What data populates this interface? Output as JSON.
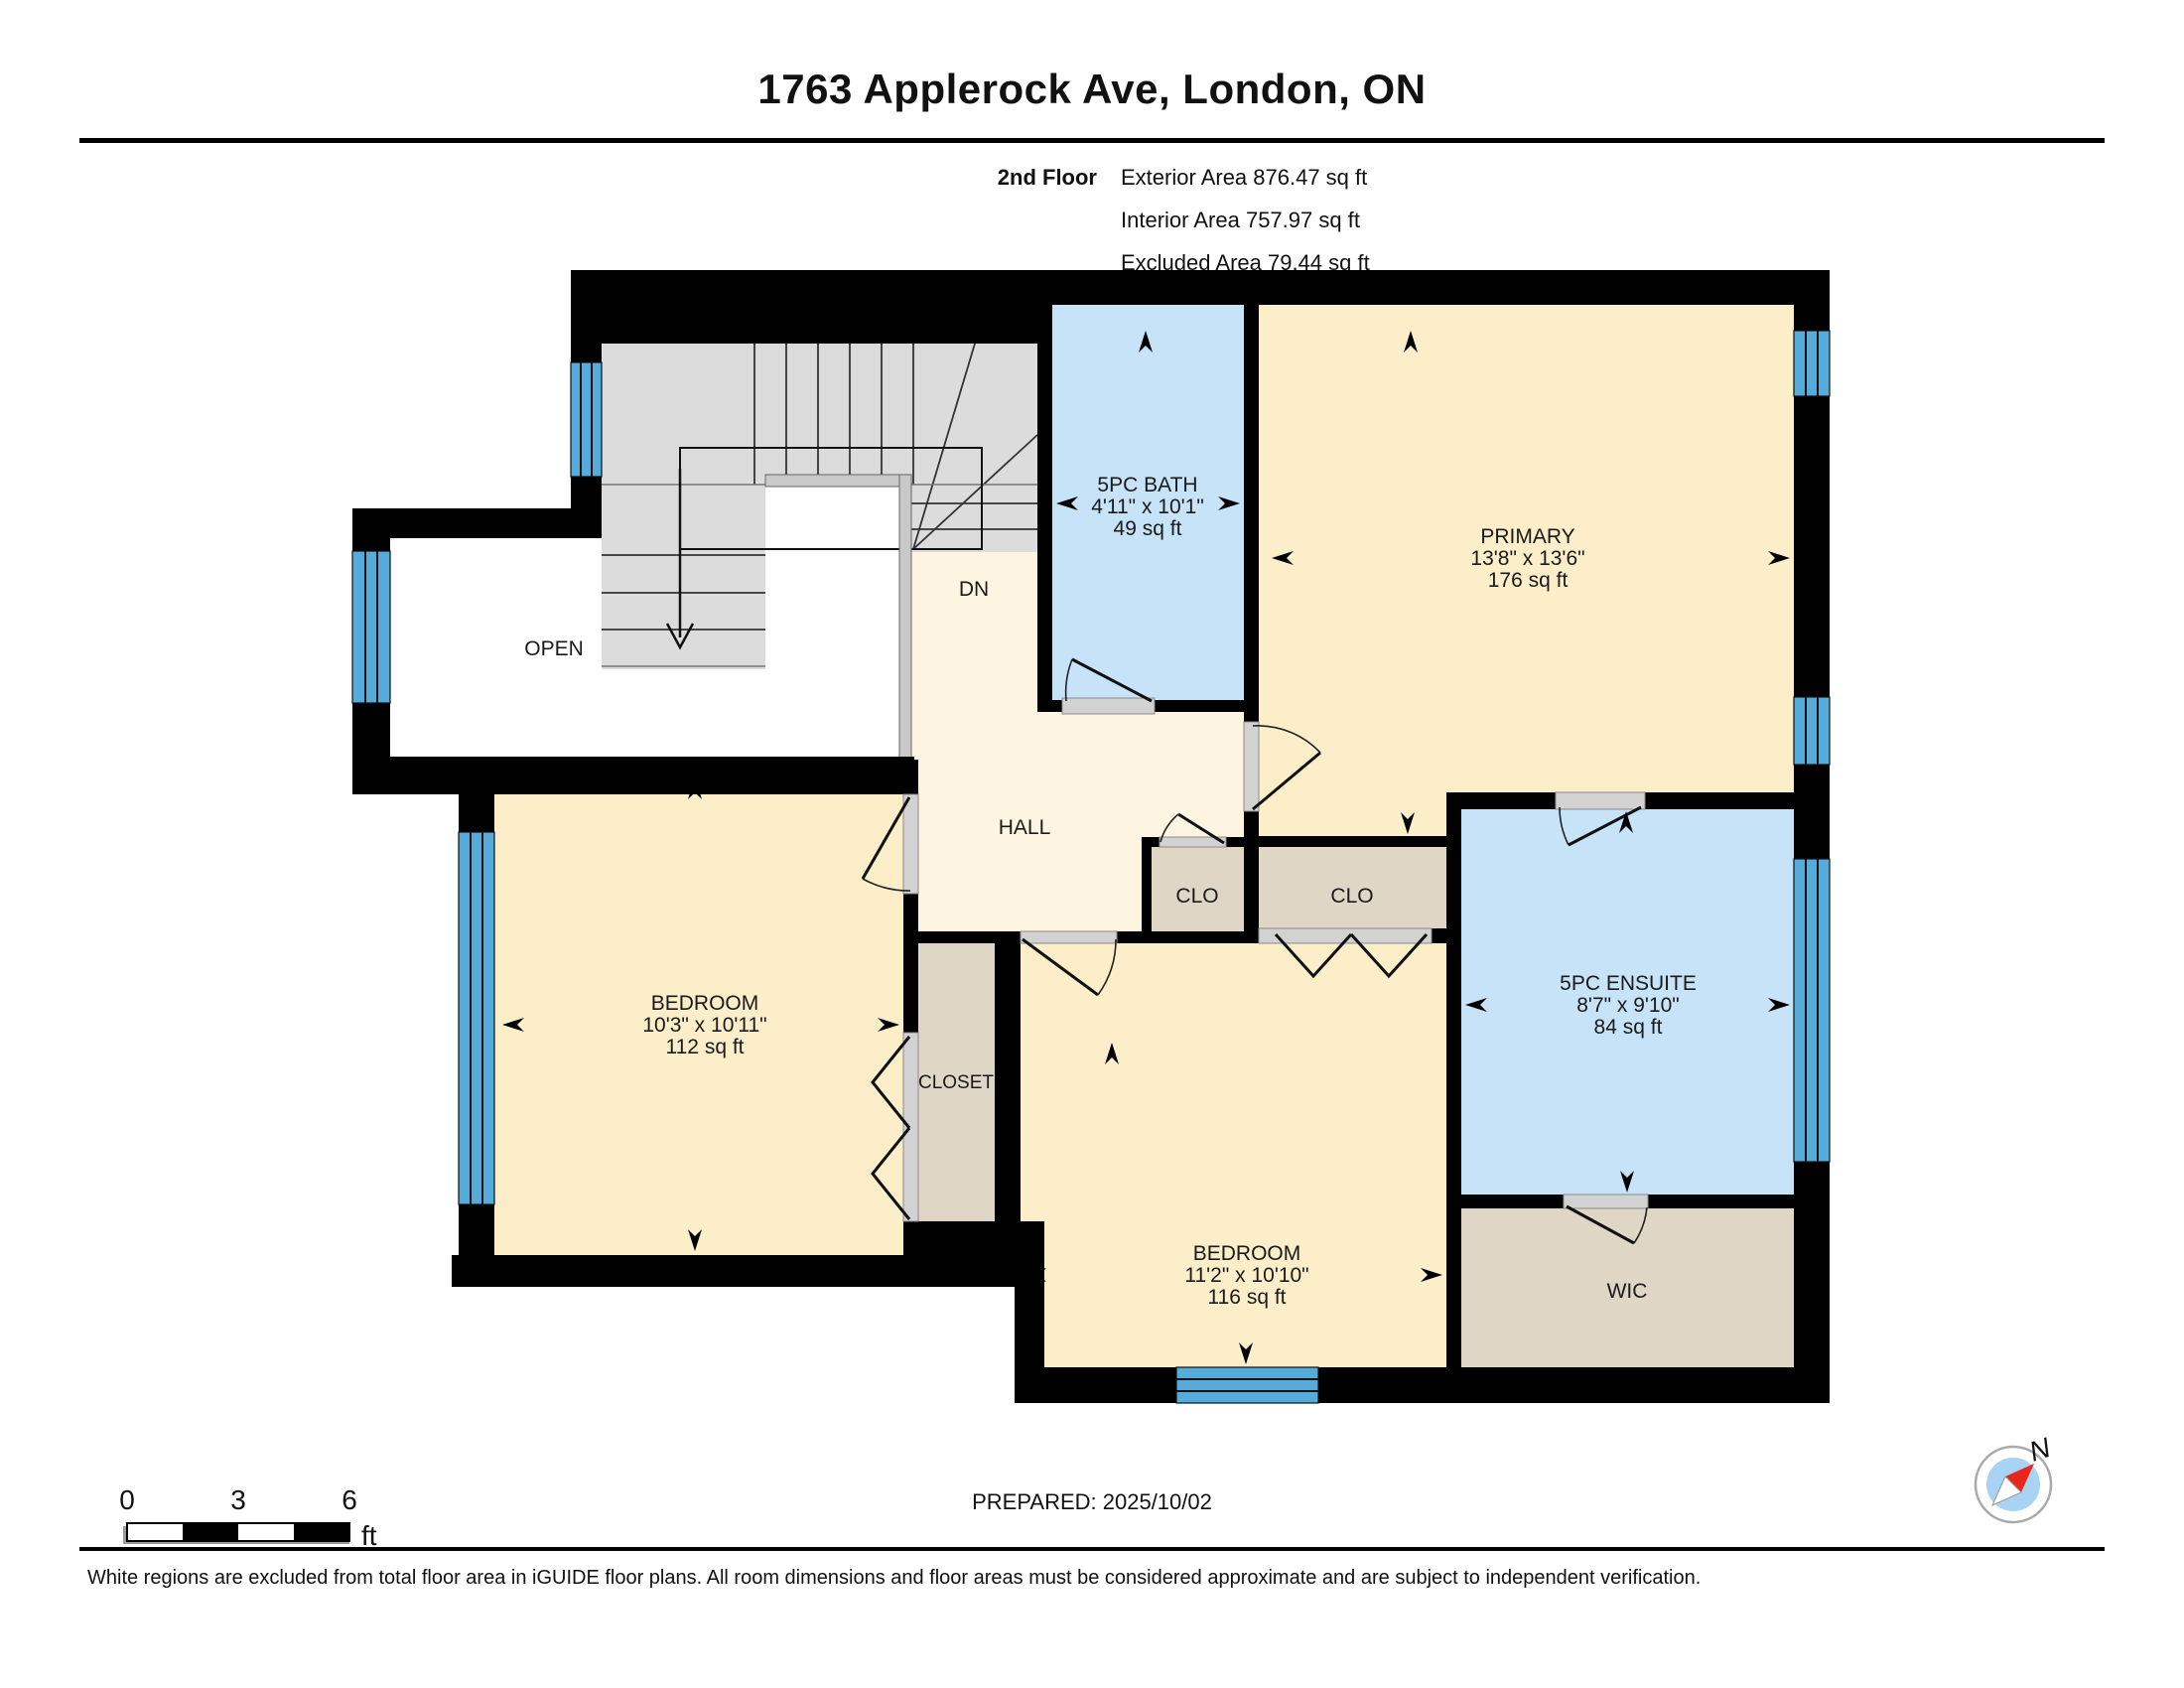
{
  "title": "1763 Applerock Ave, London, ON",
  "header": {
    "floor": "2nd Floor",
    "exterior": "Exterior Area 876.47 sq ft",
    "interior": "Interior Area 757.97 sq ft",
    "excluded": "Excluded Area 79.44 sq ft"
  },
  "rooms": {
    "stairs": {
      "dn": "DN"
    },
    "open": {
      "name": "OPEN"
    },
    "bath": {
      "name": "5PC BATH",
      "dims": "4'11\" x 10'1\"",
      "area": "49 sq ft"
    },
    "primary": {
      "name": "PRIMARY",
      "dims": "13'8\" x 13'6\"",
      "area": "176 sq ft"
    },
    "hall": {
      "name": "HALL"
    },
    "clo1": {
      "name": "CLO"
    },
    "clo2": {
      "name": "CLO"
    },
    "bedroom1": {
      "name": "BEDROOM",
      "dims": "10'3\" x 10'11\"",
      "area": "112 sq ft"
    },
    "closet": {
      "name": "CLOSET"
    },
    "bedroom2": {
      "name": "BEDROOM",
      "dims": "11'2\" x 10'10\"",
      "area": "116 sq ft"
    },
    "ensuite": {
      "name": "5PC ENSUITE",
      "dims": "8'7\" x 9'10\"",
      "area": "84 sq ft"
    },
    "wic": {
      "name": "WIC"
    }
  },
  "scale_bar": {
    "tick0": "0",
    "tick1": "3",
    "tick2": "6",
    "unit": "ft"
  },
  "prepared": "PREPARED: 2025/10/02",
  "compass": {
    "label": "N"
  },
  "disclaimer": "White regions are excluded from total floor area in iGUIDE floor plans. All room dimensions and floor areas must be considered approximate and are subject to independent verification.",
  "colors": {
    "room_yellow": "#fbeec9",
    "room_blue": "#c6e3f8",
    "room_tan": "#e0d6c6",
    "hall_cream": "#fdf5e2",
    "stairs_gray": "#dcdcdc",
    "window_blue": "#57abdb",
    "door_gray": "#d2d2d2",
    "wall_black": "#000000",
    "compass_red": "#e8251f",
    "compass_blue": "#a9d3f3"
  }
}
